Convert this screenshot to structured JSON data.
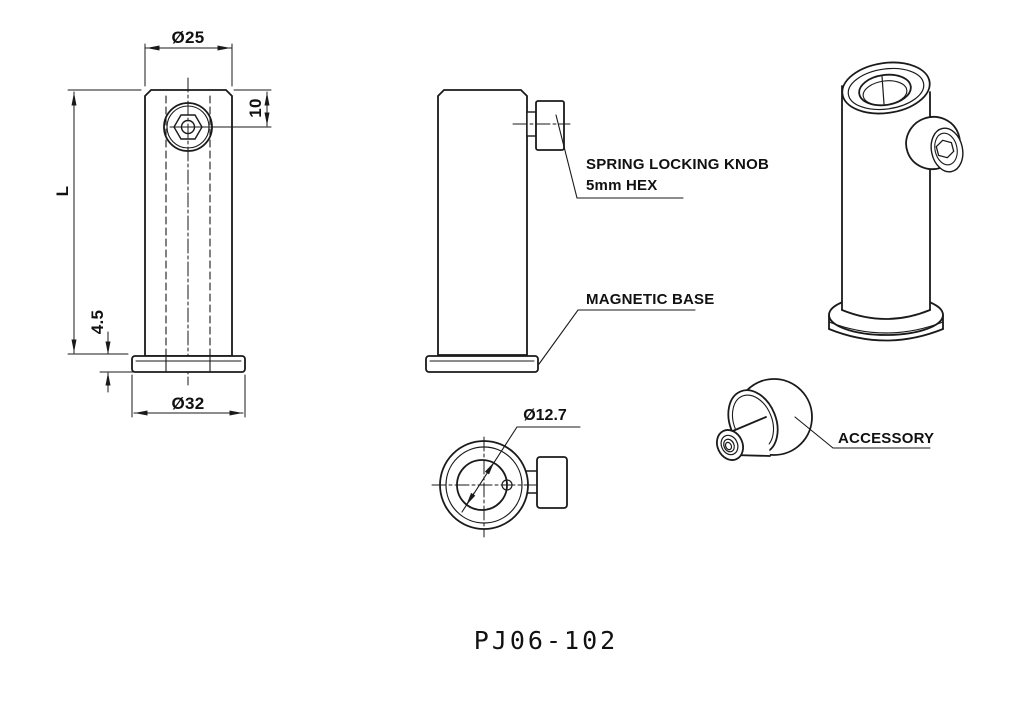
{
  "title": {
    "part_number": "PJ06-102"
  },
  "dimension_labels": {
    "post_top_diameter": "Ø25",
    "knob_center_offset": "10",
    "post_length": "L",
    "base_thickness": "4.5",
    "base_diameter": "Ø32",
    "bore_diameter": "Ø12.7"
  },
  "callouts": {
    "spring_locking_knob_line1": "SPRING LOCKING KNOB",
    "spring_locking_knob_line2": "5mm HEX",
    "magnetic_base": "MAGNETIC BASE",
    "accessory": "ACCESSORY"
  },
  "colors": {
    "line": "#1a1a1a",
    "background": "#ffffff"
  }
}
